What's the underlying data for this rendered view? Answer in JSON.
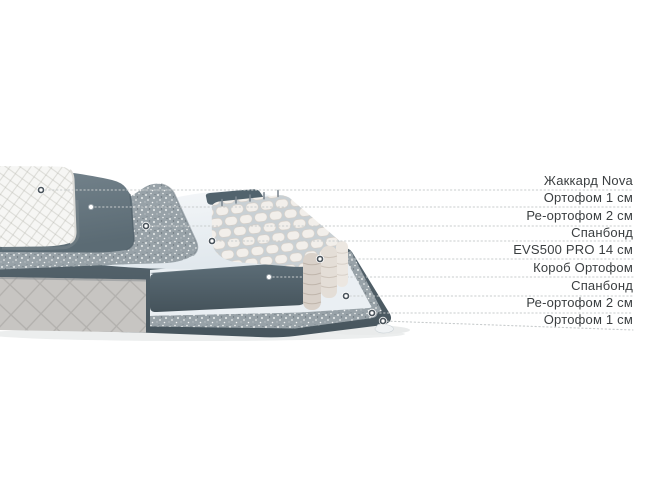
{
  "page": {
    "width": 650,
    "height": 488,
    "background": "#ffffff"
  },
  "colors": {
    "label_text": "#3a3e40",
    "leader_line": "#c8cccd",
    "dark_foam": "#4e5f68",
    "blue_gray_foam": "#66767f",
    "speckled_foam": "#98a2a8",
    "white_sheet": "#eef2f5",
    "quilt_white": "#f6f6f4",
    "quilt_side_gray": "#c7c5c2",
    "spring_pod": "#f2efeb"
  },
  "diagram": {
    "type": "mattress-layers-exploded-view",
    "layers": [
      {
        "key": "jacquard-nova",
        "label": "Жаккард Nova",
        "label_y": 181,
        "marker": {
          "x": 41,
          "y": 190
        },
        "line_end": {
          "x": 633,
          "y": 190
        }
      },
      {
        "key": "orthofoam-1cm-top",
        "label": "Ортофом 1 см",
        "label_y": 198,
        "marker": {
          "x": 91,
          "y": 207
        },
        "line_end": {
          "x": 633,
          "y": 207
        }
      },
      {
        "key": "re-orthofoam-2cm-top",
        "label": "Ре-ортофом 2 см",
        "label_y": 216,
        "marker": {
          "x": 146,
          "y": 226
        },
        "line_end": {
          "x": 633,
          "y": 226
        }
      },
      {
        "key": "spunbond-top",
        "label": "Спанбонд",
        "label_y": 233,
        "marker": {
          "x": 212,
          "y": 241
        },
        "line_end": {
          "x": 633,
          "y": 241
        }
      },
      {
        "key": "evs500-pro-14cm",
        "label": "EVS500 PRO 14 см",
        "label_y": 250,
        "marker": {
          "x": 320,
          "y": 259
        },
        "line_end": {
          "x": 633,
          "y": 259
        }
      },
      {
        "key": "korob-orthofoam",
        "label": "Короб Ортофом",
        "label_y": 268,
        "marker": {
          "x": 269,
          "y": 277
        },
        "line_end": {
          "x": 633,
          "y": 277
        }
      },
      {
        "key": "spunbond-bottom",
        "label": "Спанбонд",
        "label_y": 286,
        "marker": {
          "x": 346,
          "y": 296
        },
        "line_end": {
          "x": 633,
          "y": 296
        }
      },
      {
        "key": "re-orthofoam-2cm-bottom",
        "label": "Ре-ортофом 2 см",
        "label_y": 303,
        "marker": {
          "x": 372,
          "y": 313
        },
        "line_end": {
          "x": 633,
          "y": 313
        }
      },
      {
        "key": "orthofoam-1cm-bottom",
        "label": "Ортофом 1 см",
        "label_y": 320,
        "marker": {
          "x": 383,
          "y": 321
        },
        "line_end": {
          "x": 633,
          "y": 330
        }
      }
    ]
  }
}
